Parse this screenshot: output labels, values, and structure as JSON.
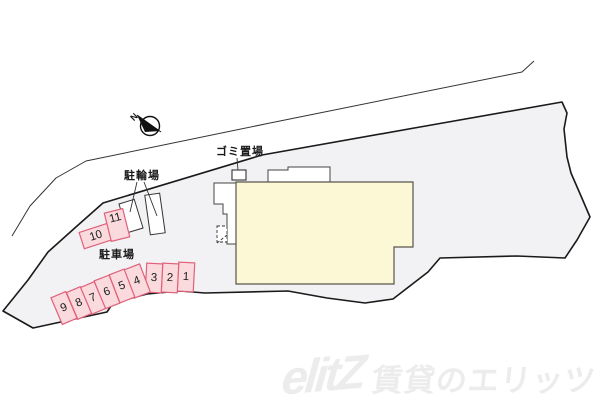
{
  "map": {
    "north_label": "N",
    "labels": {
      "garbage": "ゴミ置場",
      "bicycle_parking": "駐輪場",
      "parking_lot": "駐車場"
    },
    "parking": {
      "spaces": [
        {
          "label": "1"
        },
        {
          "label": "2"
        },
        {
          "label": "3"
        },
        {
          "label": "4"
        },
        {
          "label": "5"
        },
        {
          "label": "6"
        },
        {
          "label": "7"
        },
        {
          "label": "8"
        },
        {
          "label": "9"
        },
        {
          "label": "10"
        },
        {
          "label": "11"
        }
      ]
    },
    "colors": {
      "site_fill": "#f2f2f4",
      "building_fill": "#fcf7d4",
      "space_fill": "#fadadd",
      "space_border": "#e0607a"
    }
  },
  "watermark": {
    "logo": "elitZ",
    "text": "賃貸のエリッツ"
  }
}
